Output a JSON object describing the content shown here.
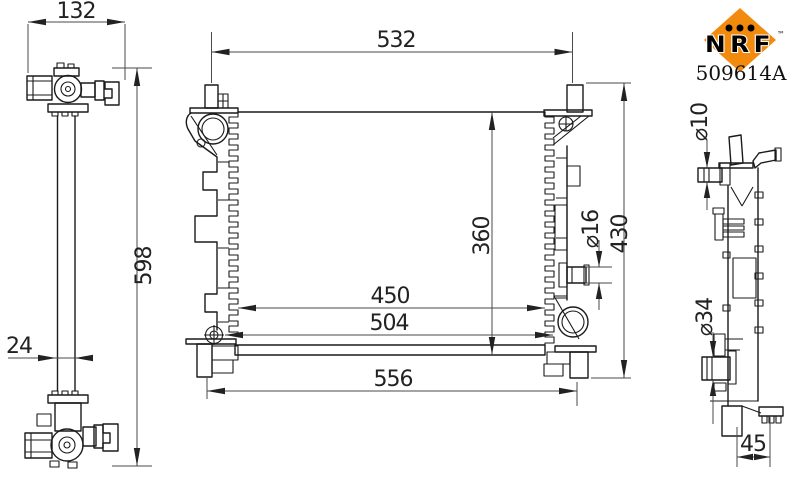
{
  "brand": {
    "name": "NRF",
    "trademark": "™",
    "part_number": "509614A",
    "logo_color": "#F28B0D"
  },
  "dimensions": {
    "top_fitting_width": "132",
    "side_overall_height": "598",
    "core_thickness": "24",
    "pin_span_width": "532",
    "core_height": "360",
    "core_width": "450",
    "mount_span": "504",
    "overall_width": "556",
    "overall_height": "430",
    "outlet_pipe_dia": "⌀16",
    "top_hose_dia": "⌀10",
    "bottom_hose_dia": "⌀34",
    "foot_offset": "45"
  },
  "drawing": {
    "line_color": "#1a1a1a",
    "dim_color": "#4a4a4a",
    "background": "#ffffff"
  }
}
